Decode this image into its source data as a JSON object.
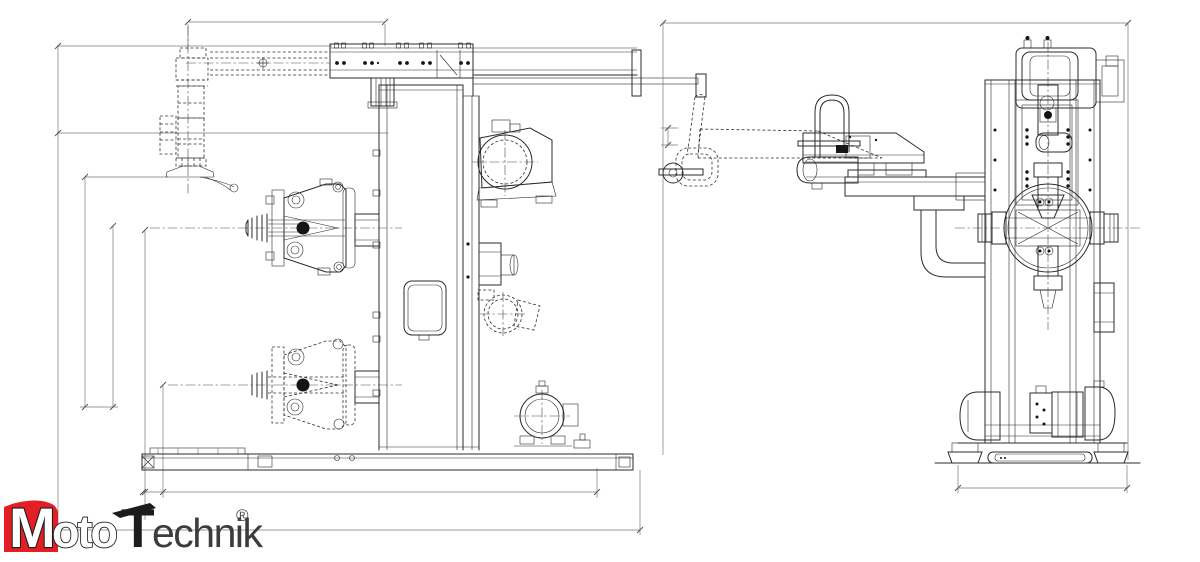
{
  "page": {
    "background_color": "#ffffff",
    "width_px": 1200,
    "height_px": 562
  },
  "drawing": {
    "type": "cad-two-view-technical-drawing",
    "subject": "industrial column machine with clamping chucks, overhead beam arm and motors",
    "views": [
      {
        "id": "left-view",
        "name": "side elevation view"
      },
      {
        "id": "right-view",
        "name": "front elevation view"
      }
    ],
    "line_color": "#2b2b2b",
    "hidden_line_style": "dashed",
    "centerline_style": "dash-dot",
    "dimension_line_color": "#787878",
    "dimension_values_visible": false
  },
  "logo": {
    "wordmark": "MotoTechnik",
    "part_m": "M",
    "part_oto": "oto",
    "part_t": "T",
    "part_echnik": "echnik",
    "registered_mark": "®",
    "accent_color": "#e31e24",
    "outline_color": "#1c1c1c",
    "text_color": "#3c3c3c"
  }
}
